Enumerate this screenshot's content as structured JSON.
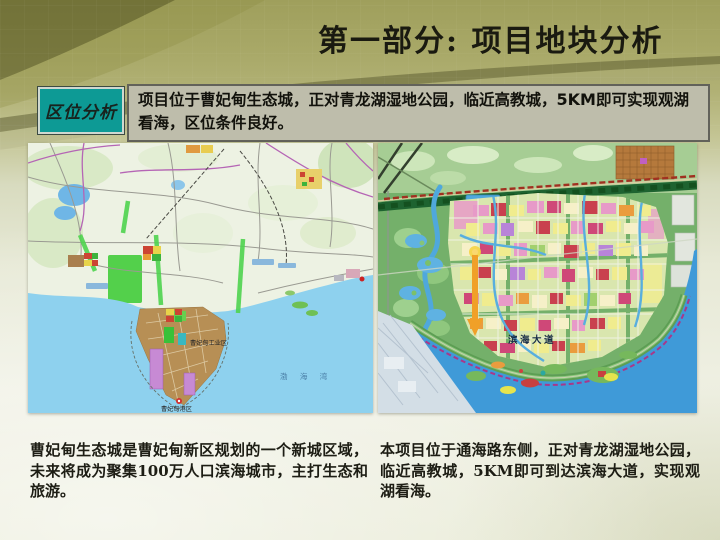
{
  "slide": {
    "title": "第一部分: 项目地块分析"
  },
  "location": {
    "label": "区位分析",
    "desc_before": "项目位于曹妃甸生态城，正对青龙湖湿地公园，临近高教城，",
    "desc_bold": "5KM",
    "desc_after": "即可实现观湖看海，区位条件良好。"
  },
  "left_map": {
    "labels": {
      "industrial_zone": "曹妃甸工业区",
      "port_zone": "曹妃甸港区",
      "bohai_bay": "渤 海 湾"
    },
    "caption": "曹妃甸生态城是曹妃甸新区规划的一个新城区域，未来将成为聚集100万人口滨海城市，主打生态和旅游。"
  },
  "right_map": {
    "labels": {
      "binhai_avenue": "滨海大道"
    },
    "caption": "本项目位于通海路东侧，正对青龙湖湿地公园，临近高教城，5KM即可到达滨海大道，实现观湖看海。"
  },
  "colors": {
    "teal_label_bg": "#0d9a95",
    "info_box_bg": "#bebdab",
    "slide_top_olive": "#9f9f5c",
    "sea_blue": "#8ed1ee",
    "plan_sea_blue": "#3f9ad8",
    "boundary_dash_red": "#a03020",
    "arrow_orange": "#f0a028"
  }
}
